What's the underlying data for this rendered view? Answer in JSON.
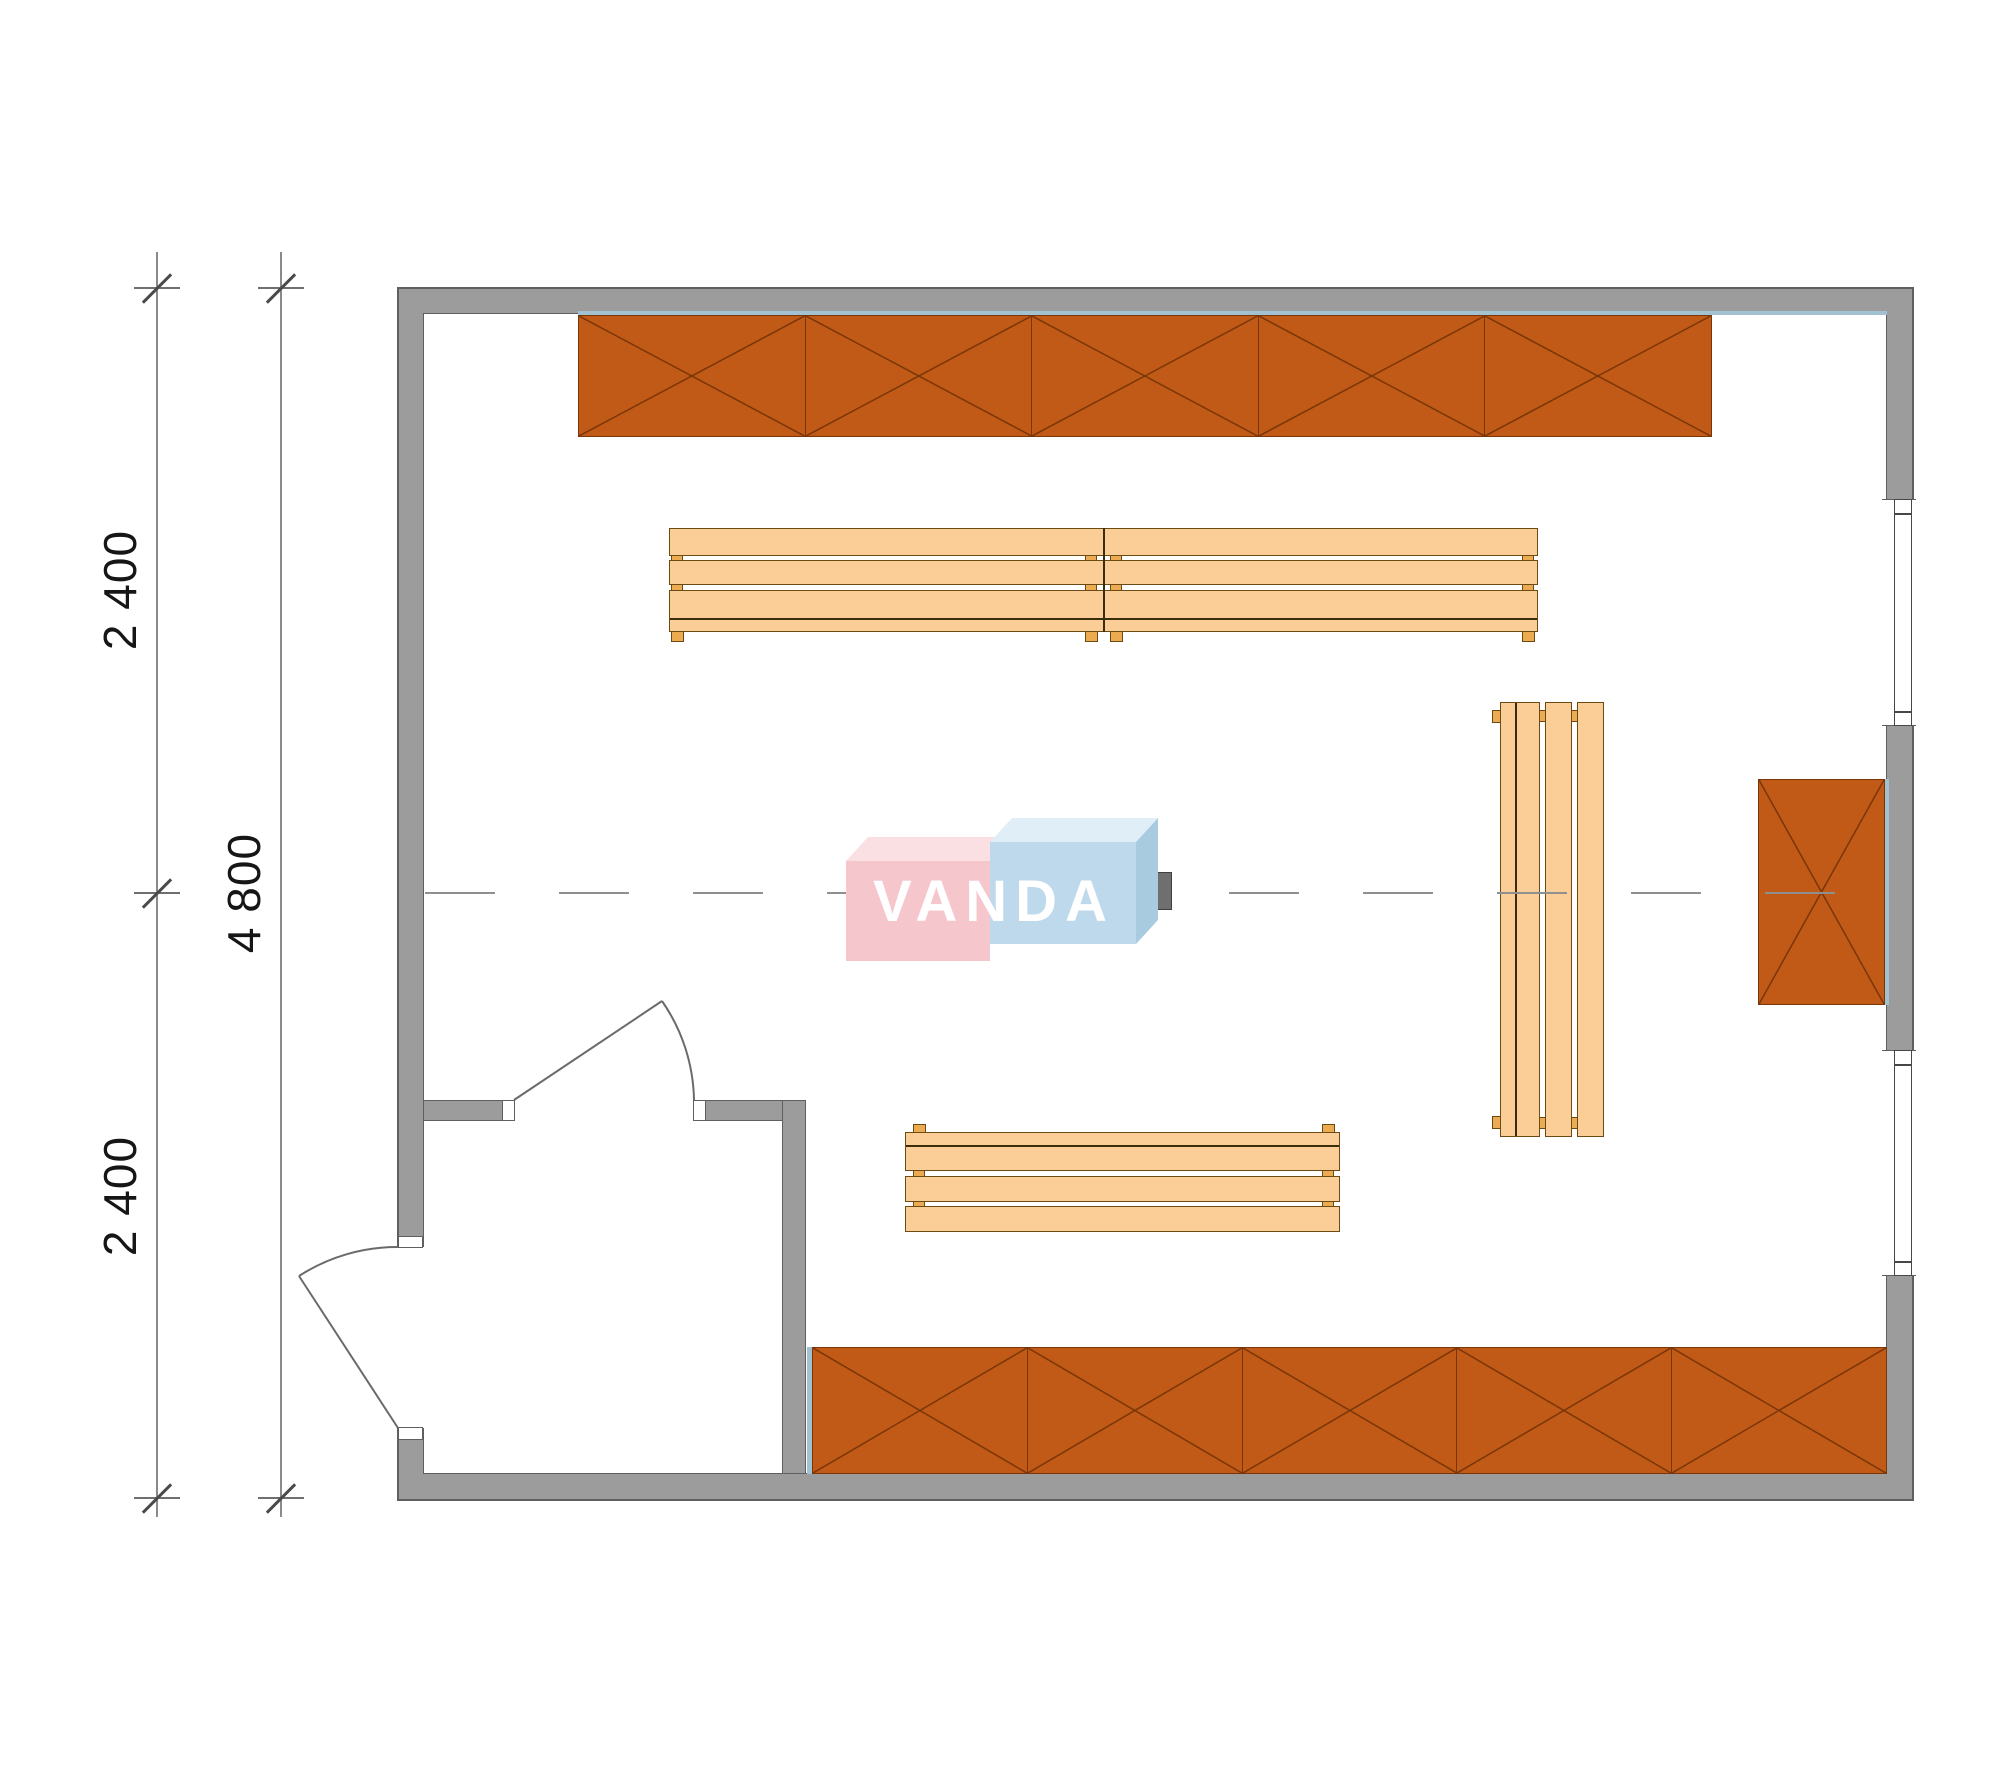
{
  "drawing": {
    "watermark": {
      "text": "VANDA"
    },
    "dimensions": {
      "segment_top": "2 400",
      "overall": "4 800",
      "segment_bottom": "2 400"
    }
  },
  "colors": {
    "wall_fill": "#9c9c9c",
    "wall_outline": "#5f5f5f",
    "shelf_fill": "#c05a16",
    "shelf_line": "#7a3509",
    "bench_fill": "#fbce97",
    "bench_line": "#6b4a14",
    "bench_dark": "#3a2d0b",
    "peg_fill": "#ecab51",
    "accent_blue": "#a3c2d1",
    "dim_line": "#8a8a8a",
    "text_color": "#161616",
    "door_line": "#6a6a6a",
    "centerline": "#8f8f8f",
    "square_blue": "#7e99a6",
    "square_gray": "#6f6f6f",
    "logo_pink": "#f5c7cd",
    "logo_pink_top": "#fadfe3",
    "logo_blue": "#bfd9ec",
    "logo_blue_top": "#e0eef7",
    "logo_blue_side": "#a9cbe0",
    "logo_text": "#ffffff"
  }
}
